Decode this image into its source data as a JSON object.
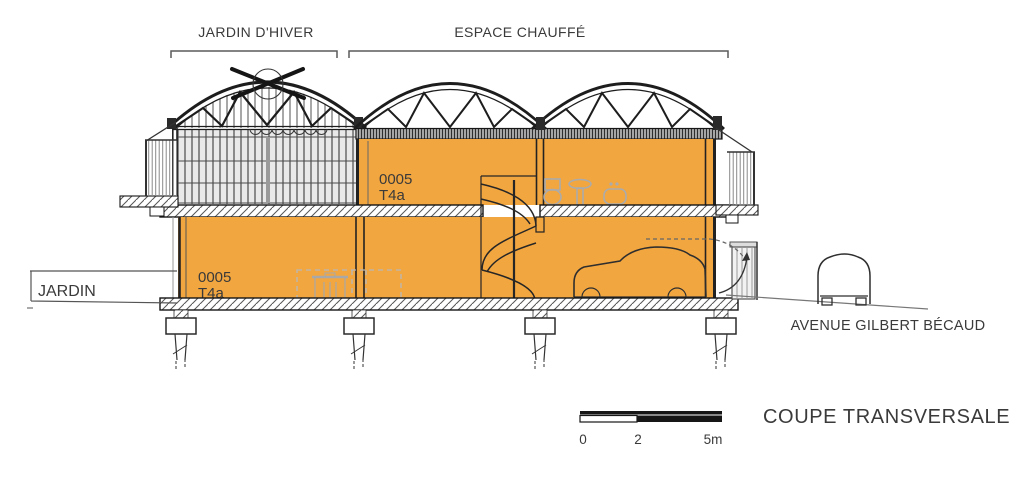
{
  "colors": {
    "heated_fill": "#F2A640",
    "winter_garden_fill": "#E9E9E9",
    "line_dark": "#222222",
    "fixture_gray": "#ABABAB",
    "text_dark": "#3A3A3A"
  },
  "annotations": {
    "winter_garden_label": "JARDIN D'HIVER",
    "heated_space_label": "ESPACE CHAUFFÉ",
    "garden_label": "JARDIN",
    "street_label": "AVENUE GILBERT BÉCAUD",
    "drawing_title": "COUPE TRANSVERSALE"
  },
  "rooms": {
    "upper_unit": {
      "number": "0005",
      "type": "T4a"
    },
    "lower_unit": {
      "number": "0005",
      "type": "T4a"
    }
  },
  "scale_bar": {
    "tick_start": "0",
    "tick_mid": "2",
    "tick_end": "5m"
  }
}
